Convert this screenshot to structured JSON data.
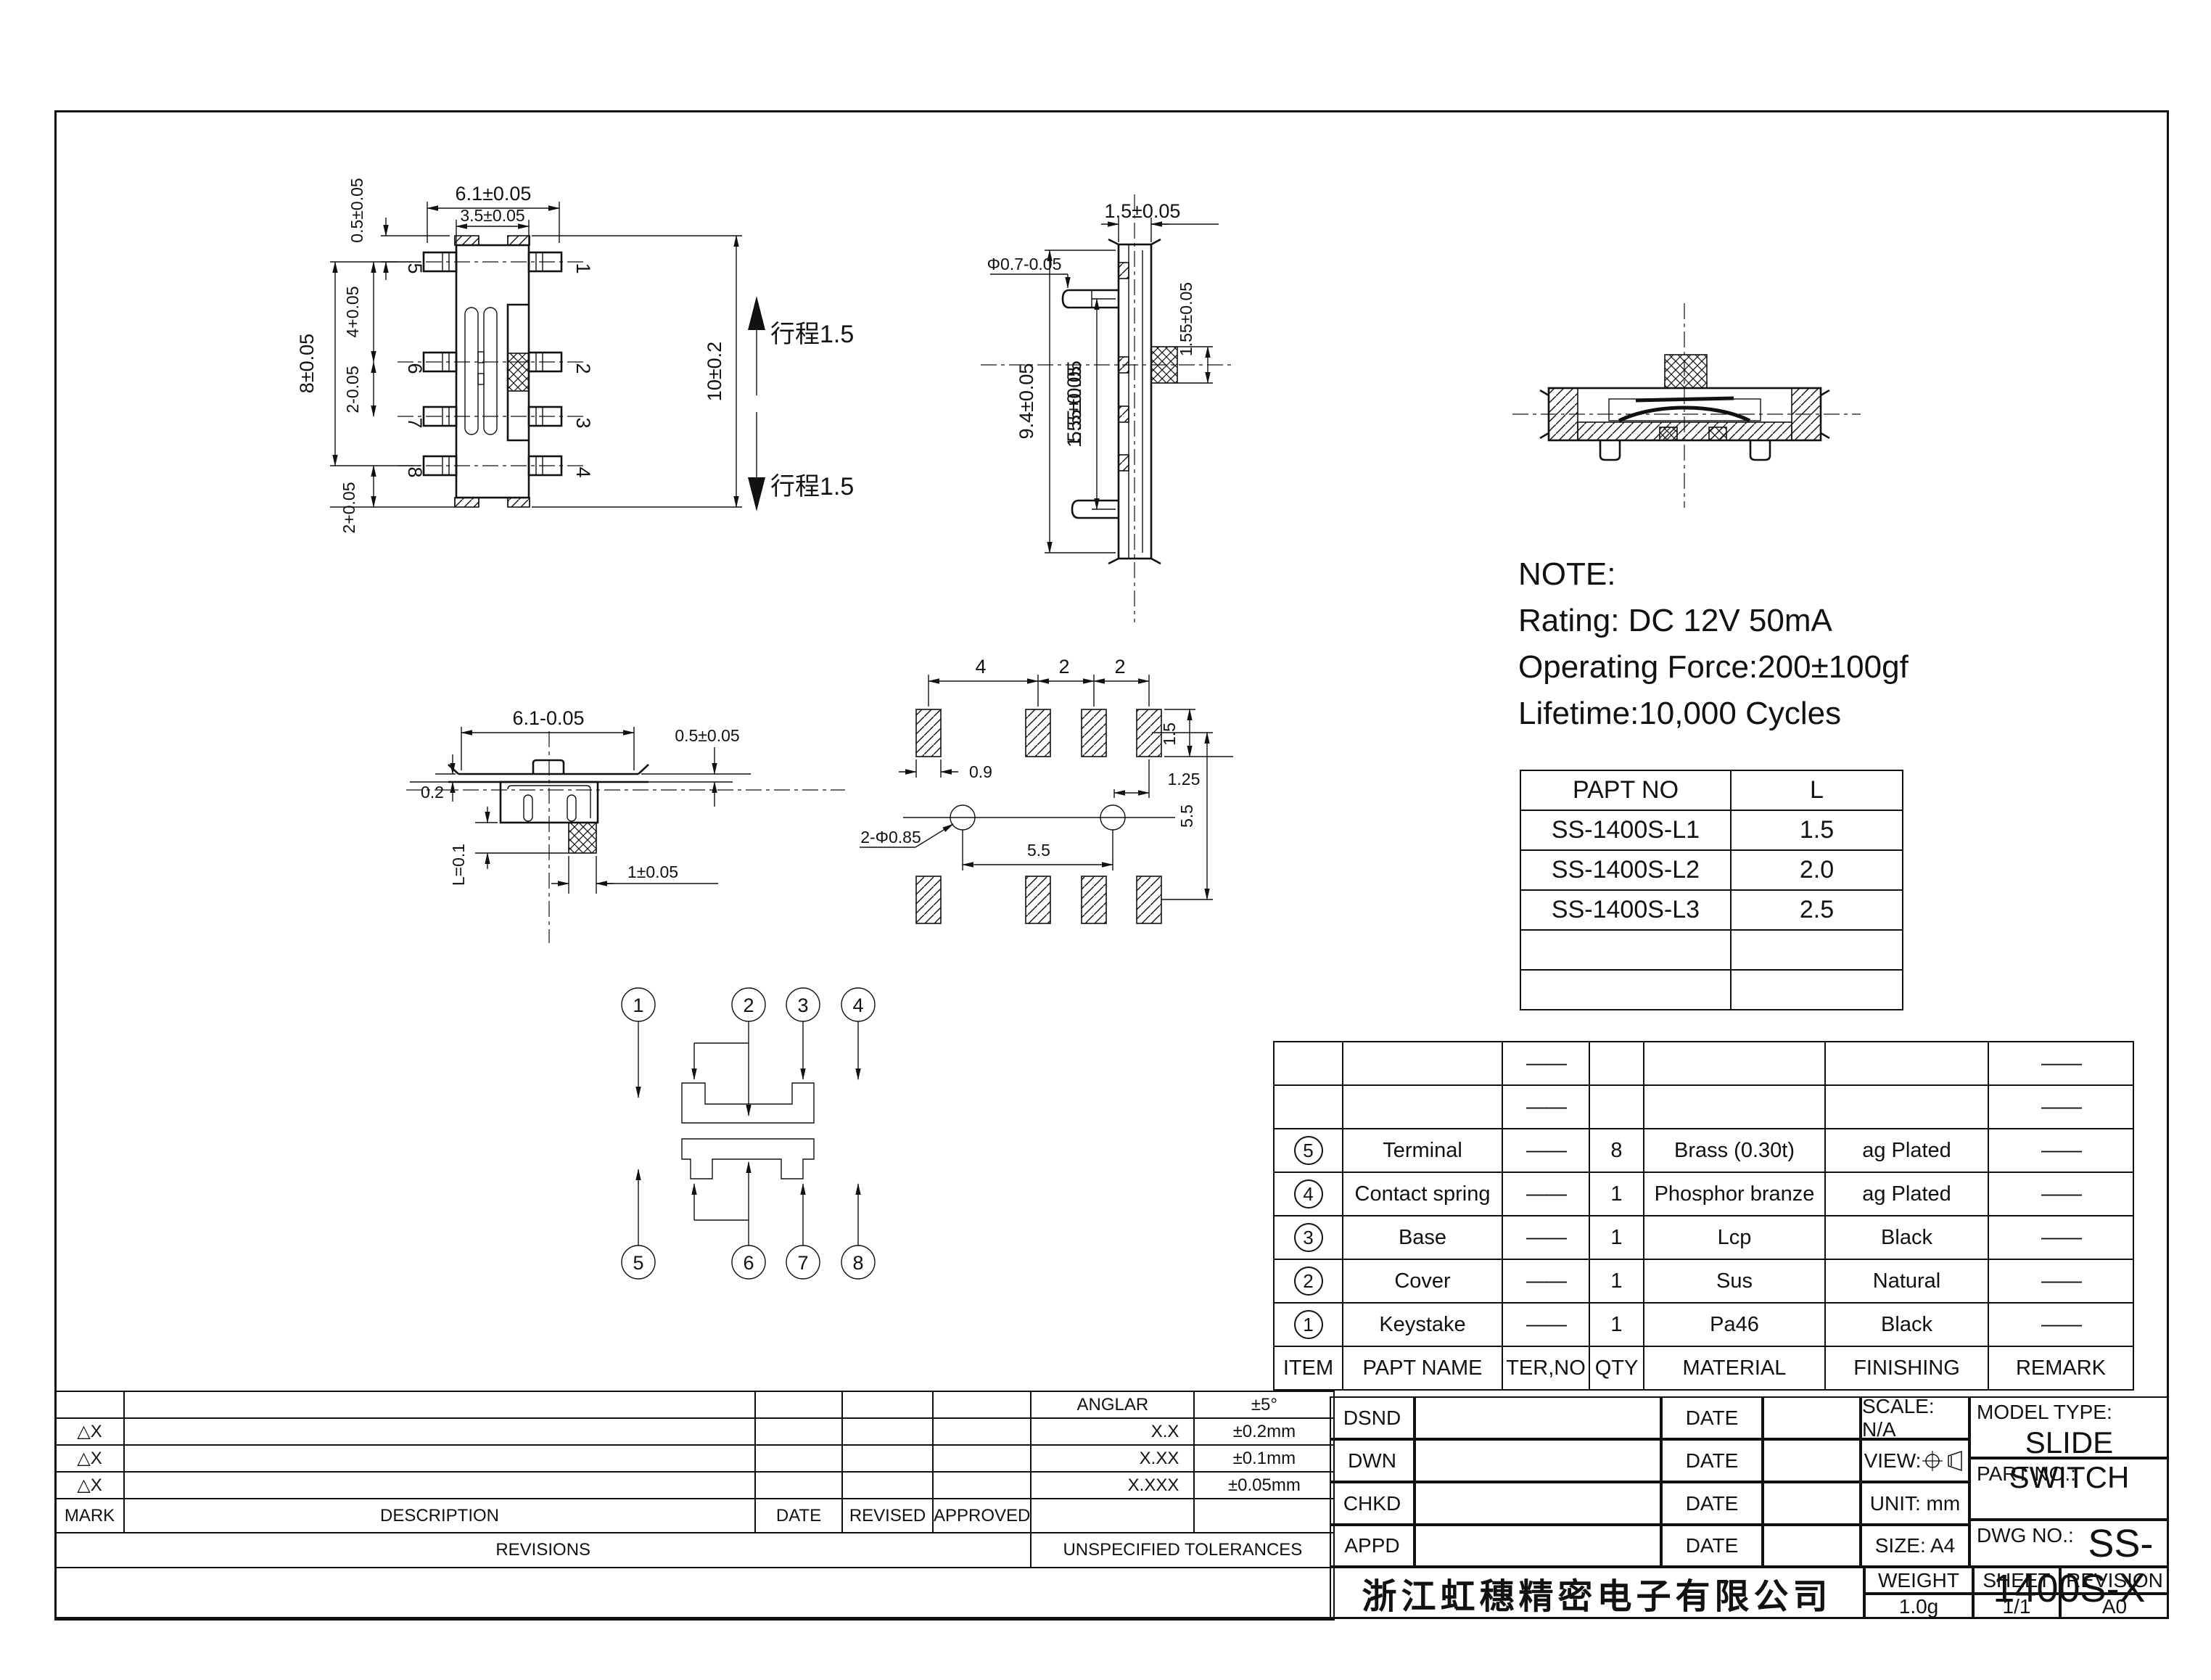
{
  "front_view": {
    "dim_width_outer": "6.1±0.05",
    "dim_width_inner": "3.5±0.05",
    "dim_pin_offset": "0.5±0.05",
    "dim_pitch_top": "4+0.05",
    "dim_pins_span": "8±0.05",
    "dim_pitch_mid": "2-0.05",
    "dim_pitch_bottom": "2+0.05",
    "dim_height": "10±0.2",
    "travel_up": "行程1.5",
    "travel_down": "行程1.5",
    "pins_right": [
      "1",
      "2",
      "3",
      "4"
    ],
    "pins_left": [
      "5",
      "6",
      "7",
      "8"
    ]
  },
  "side_view": {
    "dim_thickness": "1.5±0.05",
    "dim_pin_dia": "Φ0.7-0.05",
    "dim_height": "9.4±0.05",
    "dim_pins_span": "5.5±0.05",
    "dim_knob": "1.55±0.05"
  },
  "bottom_view": {
    "dim_width": "6.1-0.05",
    "dim_flange": "0.5±0.05",
    "dim_gap": "0.2",
    "dim_knob_len": "L=0.1",
    "dim_knob_w": "1±0.05"
  },
  "pcb_view": {
    "dim_pitch_a": "4",
    "dim_pitch_b": "2",
    "dim_pitch_c": "2",
    "dim_pad_w": "0.9",
    "dim_pad_h": "1.5",
    "dim_edge": "1.25",
    "dim_hole_span": "5.5",
    "dim_row_span": "5.5",
    "dim_holes": "2-Φ0.85"
  },
  "pin_diagram": {
    "top": [
      "1",
      "2",
      "3",
      "4"
    ],
    "bottom": [
      "5",
      "6",
      "7",
      "8"
    ]
  },
  "note": {
    "title": "NOTE:",
    "line1": "Rating: DC 12V  50mA",
    "line2": "Operating Force:200±100gf",
    "line3": "Lifetime:10,000 Cycles"
  },
  "l_table": {
    "col1": "PAPT NO",
    "col2": "L",
    "rows": [
      {
        "no": "SS-1400S-L1",
        "l": "1.5"
      },
      {
        "no": "SS-1400S-L2",
        "l": "2.0"
      },
      {
        "no": "SS-1400S-L3",
        "l": "2.5"
      },
      {
        "no": "",
        "l": ""
      },
      {
        "no": "",
        "l": ""
      }
    ]
  },
  "bom": {
    "headers": {
      "item": "ITEM",
      "name": "PAPT NAME",
      "terno": "TER,NO",
      "qty": "QTY",
      "material": "MATERIAL",
      "finishing": "FINISHING",
      "remark": "REMARK"
    },
    "dash": "——",
    "rows": [
      {
        "item": "5",
        "name": "Terminal",
        "qty": "8",
        "material": "Brass (0.30t)",
        "finishing": "ag Plated"
      },
      {
        "item": "4",
        "name": "Contact spring",
        "qty": "1",
        "material": "Phosphor branze",
        "finishing": "ag Plated"
      },
      {
        "item": "3",
        "name": "Base",
        "qty": "1",
        "material": "Lcp",
        "finishing": "Black"
      },
      {
        "item": "2",
        "name": "Cover",
        "qty": "1",
        "material": "Sus",
        "finishing": "Natural"
      },
      {
        "item": "1",
        "name": "Keystake",
        "qty": "1",
        "material": "Pa46",
        "finishing": "Black"
      }
    ]
  },
  "revisions": {
    "mark": "MARK",
    "description": "DESCRIPTION",
    "date": "DATE",
    "revised": "REVISED",
    "approved": "APPROVED",
    "title": "REVISIONS",
    "unspecified": "UNSPECIFIED TOLERANCES",
    "mark_symbol": "△X",
    "tolerances": [
      {
        "range": "ANGLAR",
        "value": "±5°"
      },
      {
        "range": "X.X",
        "value": "±0.2mm"
      },
      {
        "range": "X.XX",
        "value": "±0.1mm"
      },
      {
        "range": "X.XXX",
        "value": "±0.05mm"
      }
    ]
  },
  "title_block": {
    "dsnd": "DSND",
    "dwn": "DWN",
    "chkd": "CHKD",
    "appd": "APPD",
    "date": "DATE",
    "scale": "SCALE: N/A",
    "view": "VIEW:",
    "unit": "UNIT: mm",
    "size": "SIZE: A4",
    "model_type_label": "MODEL TYPE:",
    "model_type": "SLIDE SWITCH",
    "part_no_label": "PART NO.:",
    "dwg_no_label": "DWG NO.:",
    "dwg_no": "SS-1400S-X",
    "company": "浙江虹穗精密电子有限公司",
    "weight_label": "WEIGHT",
    "weight": "1.0g",
    "sheet_label": "SHEET",
    "sheet": "1/1",
    "revision_label": "REVISION",
    "revision": "A0"
  }
}
